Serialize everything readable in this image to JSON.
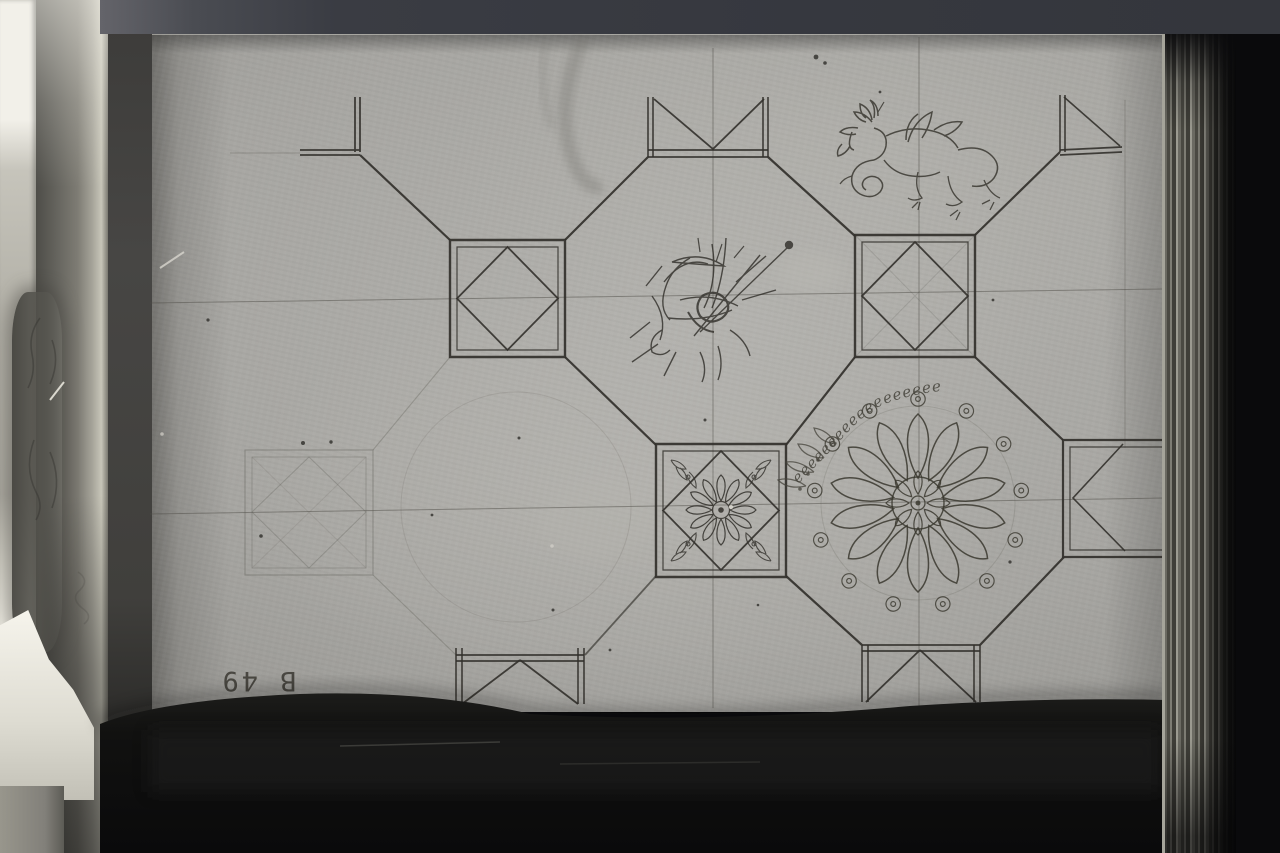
{
  "scene": {
    "kind": "black-and-white photograph of an open sketchbook page with a coffered ceiling design",
    "page_number_stamp": "B 49",
    "vine_glyphs": "eeeeeeeeeeeeeeeeee",
    "motifs": [
      "octagon-and-square coffer grid",
      "squares with inscribed diamonds",
      "ornate square coffer with rosette and corner leaves",
      "large many-petalled rosette",
      "scrolling vine garland",
      "winged dragon ink sketch",
      "dense ink scribble study"
    ],
    "colors": {
      "background": "#0a0a0c",
      "top_band": "#36383f",
      "paper": "#a7a6a2",
      "ink": "#32302b",
      "pencil_guide": "#4f4d47",
      "white_book_edge": "#f2f0e9",
      "page_stack": "#6b6a62"
    }
  }
}
